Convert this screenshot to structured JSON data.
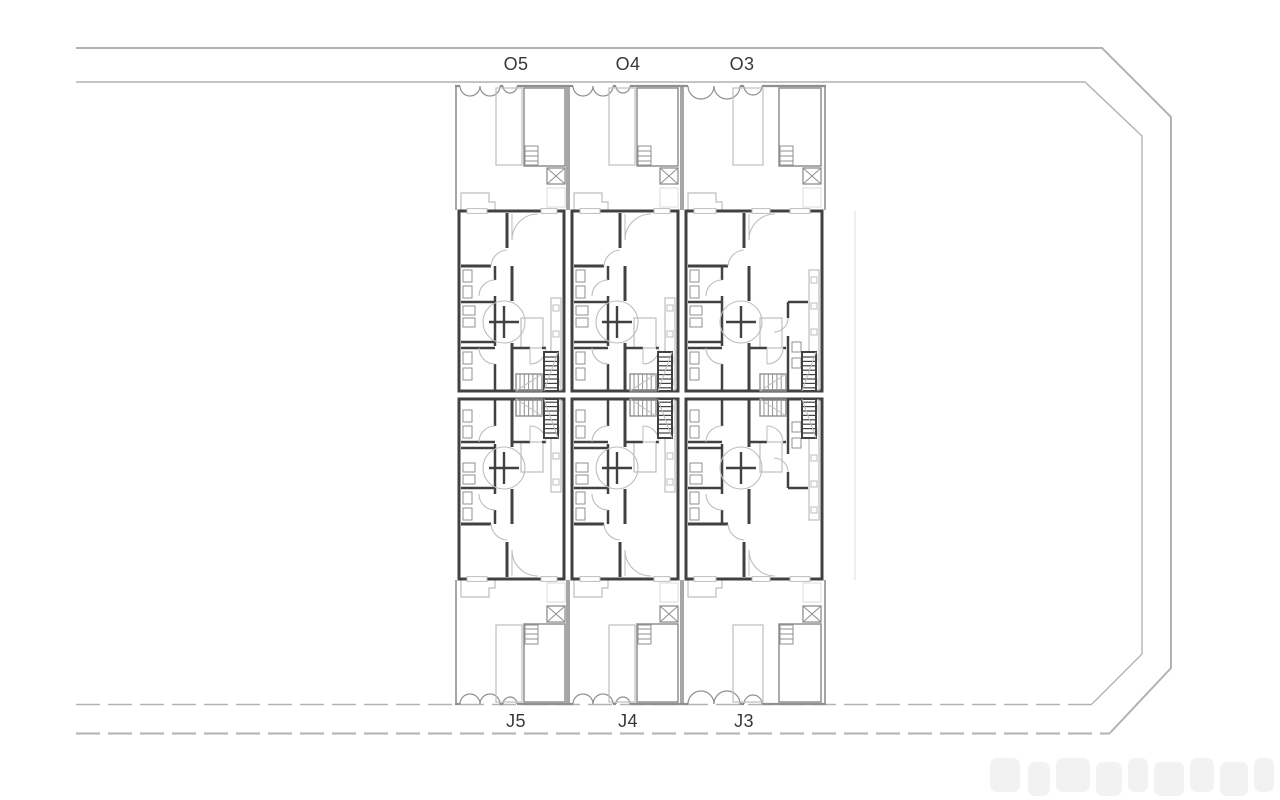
{
  "plan": {
    "columns": [
      {
        "top_label": "O5",
        "bottom_label": "J5"
      },
      {
        "top_label": "O4",
        "bottom_label": "J4"
      },
      {
        "top_label": "O3",
        "bottom_label": "J3"
      }
    ],
    "colors": {
      "background": "#ffffff",
      "boundary": "#b2b2b2",
      "wall": "#414141",
      "medium": "#8f8f8f",
      "light": "#bdbdbd",
      "faint": "#dedede",
      "label": "#383838",
      "watermark": "#f1f1f1"
    }
  }
}
